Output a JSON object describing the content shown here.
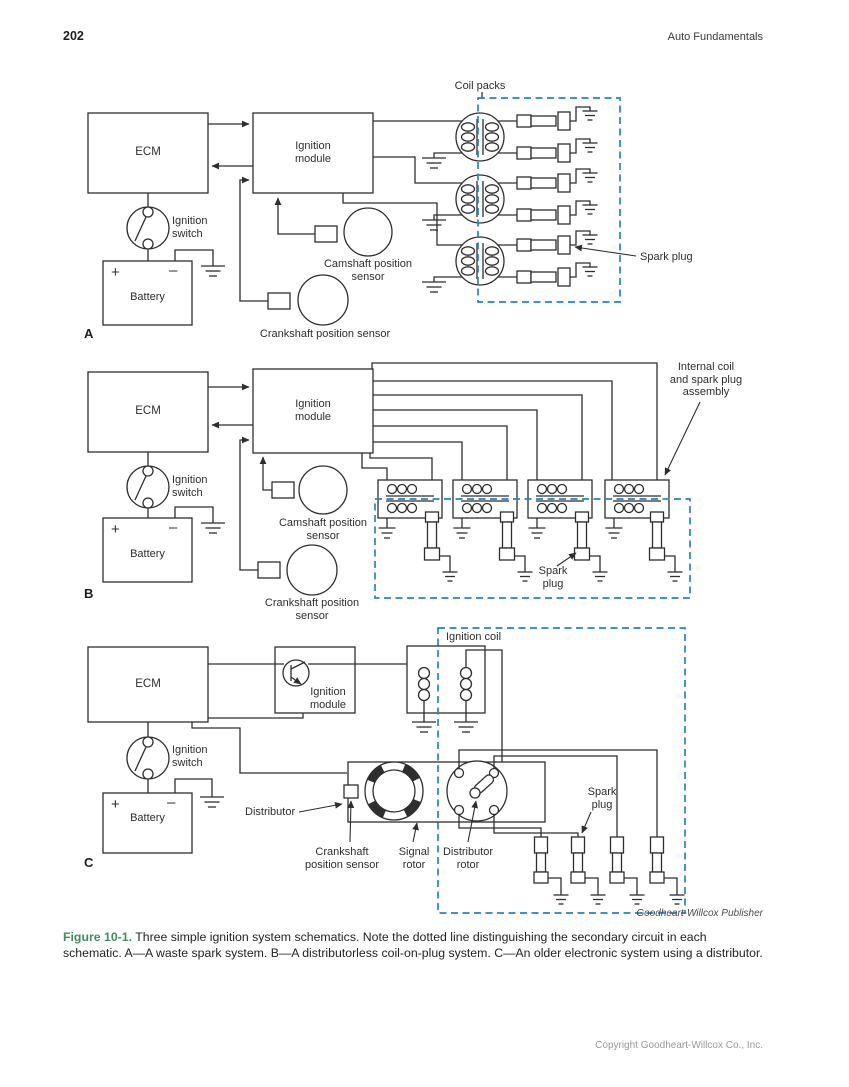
{
  "page": {
    "page_number": "202",
    "running_header": "Auto Fundamentals",
    "publisher_credit": "Goodheart-Willcox Publisher",
    "copyright": "Copyright Goodheart-Willcox Co., Inc."
  },
  "caption": {
    "figure_label": "Figure 10-1.",
    "text": " Three simple ignition system schematics. Note the dotted line distinguishing the secondary circuit in each schematic. A—A waste spark system. B—A distributorless coil-on-plug system. C—An older electronic system using a distributor."
  },
  "diagram_a": {
    "label": "A",
    "coil_packs": "Coil packs",
    "ecm": "ECM",
    "ignition_module": "Ignition\nmodule",
    "ignition_switch": "Ignition\nswitch",
    "battery": "Battery",
    "battery_plus": "+",
    "battery_minus": "–",
    "camshaft_sensor": "Camshaft position\nsensor",
    "crankshaft_sensor": "Crankshaft position sensor",
    "spark_plug": "Spark plug"
  },
  "diagram_b": {
    "label": "B",
    "ecm": "ECM",
    "ignition_module": "Ignition\nmodule",
    "ignition_switch": "Ignition\nswitch",
    "battery": "Battery",
    "battery_plus": "+",
    "battery_minus": "–",
    "camshaft_sensor": "Camshaft position\nsensor",
    "crankshaft_sensor": "Crankshaft position\nsensor",
    "internal_coil_assembly": "Internal coil\nand spark plug\nassembly",
    "spark_plug": "Spark\nplug"
  },
  "diagram_c": {
    "label": "C",
    "ecm": "ECM",
    "ignition_module": "Ignition\nmodule",
    "ignition_coil": "Ignition coil",
    "ignition_switch": "Ignition\nswitch",
    "battery": "Battery",
    "battery_plus": "+",
    "battery_minus": "–",
    "distributor": "Distributor",
    "crankshaft_sensor": "Crankshaft\nposition sensor",
    "signal_rotor": "Signal\nrotor",
    "distributor_rotor": "Distributor\nrotor",
    "spark_plug": "Spark\nplug"
  },
  "colors": {
    "secondary_circuit_dash": "#2583c6",
    "figure_label_green": "#3f8f5f",
    "line": "#2e2e2e",
    "copyright_gray": "#9a9a9a"
  }
}
